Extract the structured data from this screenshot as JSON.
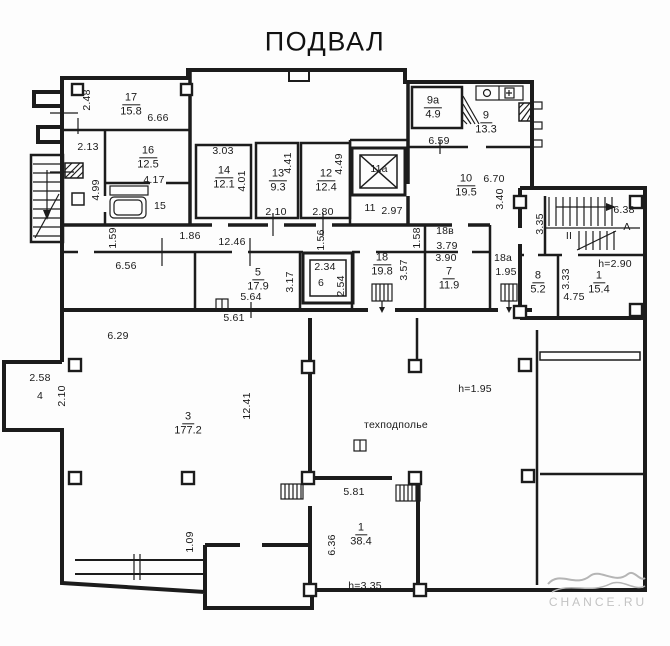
{
  "title": "ПОДВАЛ",
  "watermark": "CHANCE.RU",
  "icons": [
    "elevator-shaft-cross",
    "stair-treads",
    "down-arrow",
    "sink",
    "bathtub",
    "hatch-vent",
    "column-square"
  ],
  "rooms": [
    {
      "num": "17",
      "area": "15.8",
      "x": 131,
      "y": 105
    },
    {
      "num": "16",
      "area": "12.5",
      "x": 148,
      "y": 158
    },
    {
      "num": "14",
      "area": "12.1",
      "x": 224,
      "y": 178
    },
    {
      "num": "13",
      "area": "9.3",
      "x": 278,
      "y": 181
    },
    {
      "num": "12",
      "area": "12.4",
      "x": 326,
      "y": 181
    },
    {
      "num": "9а",
      "area": "4.9",
      "x": 433,
      "y": 108
    },
    {
      "num": "9",
      "area": "13.3",
      "x": 486,
      "y": 123
    },
    {
      "num": "10",
      "area": "19.5",
      "x": 466,
      "y": 186
    },
    {
      "num": "5",
      "area": "17.9",
      "x": 258,
      "y": 280
    },
    {
      "num": "18",
      "area": "19.8",
      "x": 382,
      "y": 265
    },
    {
      "num": "7",
      "area": "11.9",
      "x": 449,
      "y": 279
    },
    {
      "num": "8",
      "area": "5.2",
      "x": 538,
      "y": 283
    },
    {
      "num": "1",
      "area": "15.4",
      "x": 599,
      "y": 283
    },
    {
      "num": "3",
      "area": "177.2",
      "x": 188,
      "y": 424
    },
    {
      "num": "1",
      "area": "38.4",
      "x": 361,
      "y": 535
    }
  ],
  "labels": [
    {
      "text": "2.48",
      "x": 87,
      "y": 100,
      "rot": 1
    },
    {
      "text": "6.66",
      "x": 158,
      "y": 118
    },
    {
      "text": "2.13",
      "x": 88,
      "y": 147
    },
    {
      "text": "4.17",
      "x": 154,
      "y": 180
    },
    {
      "text": "4.99",
      "x": 96,
      "y": 190,
      "rot": 1
    },
    {
      "text": "15",
      "x": 160,
      "y": 206
    },
    {
      "text": "3.03",
      "x": 223,
      "y": 151
    },
    {
      "text": "4.01",
      "x": 242,
      "y": 181,
      "rot": 1
    },
    {
      "text": "4.41",
      "x": 288,
      "y": 163,
      "rot": 1
    },
    {
      "text": "2.10",
      "x": 276,
      "y": 212
    },
    {
      "text": "4.49",
      "x": 339,
      "y": 164,
      "rot": 1
    },
    {
      "text": "2.80",
      "x": 323,
      "y": 212
    },
    {
      "text": "11а",
      "x": 379,
      "y": 169
    },
    {
      "text": "11",
      "x": 370,
      "y": 208
    },
    {
      "text": "2.97",
      "x": 392,
      "y": 211
    },
    {
      "text": "6.59",
      "x": 439,
      "y": 141
    },
    {
      "text": "6.70",
      "x": 494,
      "y": 179
    },
    {
      "text": "3.40",
      "x": 500,
      "y": 199,
      "rot": 1
    },
    {
      "text": "1.59",
      "x": 113,
      "y": 238,
      "rot": 1
    },
    {
      "text": "1.86",
      "x": 190,
      "y": 236
    },
    {
      "text": "12.46",
      "x": 232,
      "y": 242
    },
    {
      "text": "6.56",
      "x": 126,
      "y": 266
    },
    {
      "text": "3.17",
      "x": 290,
      "y": 282,
      "rot": 1
    },
    {
      "text": "5.64",
      "x": 251,
      "y": 297
    },
    {
      "text": "2.34",
      "x": 325,
      "y": 267
    },
    {
      "text": "6",
      "x": 321,
      "y": 283
    },
    {
      "text": "2.54",
      "x": 341,
      "y": 286,
      "rot": 1
    },
    {
      "text": "3.57",
      "x": 404,
      "y": 270,
      "rot": 1
    },
    {
      "text": "1.56",
      "x": 321,
      "y": 240,
      "rot": 1
    },
    {
      "text": "1.58",
      "x": 417,
      "y": 238,
      "rot": 1
    },
    {
      "text": "18в",
      "x": 445,
      "y": 231
    },
    {
      "text": "3.79",
      "x": 447,
      "y": 246
    },
    {
      "text": "3.90",
      "x": 446,
      "y": 258
    },
    {
      "text": "18а",
      "x": 503,
      "y": 258
    },
    {
      "text": "1.95",
      "x": 506,
      "y": 272
    },
    {
      "text": "3.35",
      "x": 540,
      "y": 224,
      "rot": 1
    },
    {
      "text": "6.38",
      "x": 624,
      "y": 210
    },
    {
      "text": "А",
      "x": 627,
      "y": 227
    },
    {
      "text": "II",
      "x": 569,
      "y": 236
    },
    {
      "text": "h=2.90",
      "x": 615,
      "y": 264
    },
    {
      "text": "3.33",
      "x": 566,
      "y": 279,
      "rot": 1
    },
    {
      "text": "4.75",
      "x": 574,
      "y": 297
    },
    {
      "text": "5.61",
      "x": 234,
      "y": 318
    },
    {
      "text": "6.29",
      "x": 118,
      "y": 336
    },
    {
      "text": "2.58",
      "x": 40,
      "y": 378
    },
    {
      "text": "4",
      "x": 40,
      "y": 396
    },
    {
      "text": "2.10",
      "x": 62,
      "y": 396,
      "rot": 1
    },
    {
      "text": "12.41",
      "x": 247,
      "y": 406,
      "rot": 1
    },
    {
      "text": "техподполье",
      "x": 396,
      "y": 425
    },
    {
      "text": "h=1.95",
      "x": 475,
      "y": 389
    },
    {
      "text": "5.81",
      "x": 354,
      "y": 492
    },
    {
      "text": "6.36",
      "x": 332,
      "y": 545,
      "rot": 1
    },
    {
      "text": "h=3.35",
      "x": 365,
      "y": 586
    },
    {
      "text": "1.09",
      "x": 190,
      "y": 542,
      "rot": 1
    }
  ]
}
